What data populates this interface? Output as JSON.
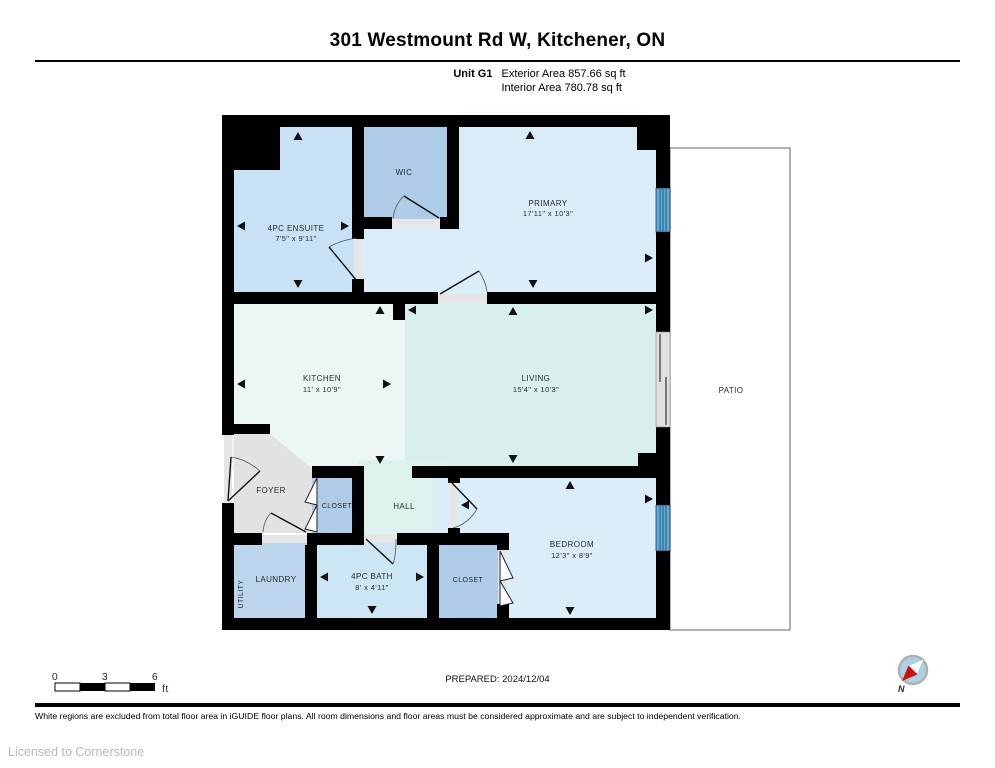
{
  "header": {
    "title": "301 Westmount Rd W, Kitchener, ON",
    "unit": "Unit G1",
    "exterior": "Exterior Area 857.66 sq ft",
    "interior": "Interior Area 780.78 sq ft"
  },
  "rooms": {
    "ensuite": {
      "name": "4PC ENSUITE",
      "dims": "7'5\" x 9'11\""
    },
    "wic": {
      "name": "WIC"
    },
    "primary": {
      "name": "PRIMARY",
      "dims": "17'11\" x 10'3\""
    },
    "kitchen": {
      "name": "KITCHEN",
      "dims": "11' x 10'9\""
    },
    "living": {
      "name": "LIVING",
      "dims": "15'4\" x 10'3\""
    },
    "patio": {
      "name": "PATIO"
    },
    "foyer": {
      "name": "FOYER"
    },
    "closet1": {
      "name": "CLOSET"
    },
    "hall": {
      "name": "HALL"
    },
    "utility": {
      "name": "UTILITY"
    },
    "laundry": {
      "name": "LAUNDRY"
    },
    "bath": {
      "name": "4PC BATH",
      "dims": "8' x 4'11\""
    },
    "closet2": {
      "name": "CLOSET"
    },
    "bedroom": {
      "name": "BEDROOM",
      "dims": "12'3\" x 8'9\""
    }
  },
  "scale_bar": {
    "ticks": [
      "0",
      "3",
      "6"
    ],
    "unit": "ft"
  },
  "compass": {
    "north_label": "N"
  },
  "footer": {
    "prepared": "PREPARED: 2024/12/04",
    "disclaimer": "White regions are excluded from total floor area in iGUIDE floor plans. All room dimensions and floor areas must be considered approximate and are subject to independent verification.",
    "license": "Licensed to Cornerstone"
  },
  "colors": {
    "wall": "#000000",
    "ensuite": "#c8e1f5",
    "wic": "#aecbe8",
    "primary": "#daedf9",
    "kitchen": "#ecf7f5",
    "living": "#d9efee",
    "hall": "#ddf1ee",
    "foyer": "#e2e2e2",
    "closet": "#aecbe8",
    "laundry": "#bdd5ec",
    "bath": "#cde6f6",
    "bedroom": "#daedf9",
    "window": "#5fabdc",
    "sill": "#e6e6e6",
    "patio_border": "#7f7f7f",
    "compass_face": "#a9d3e9",
    "compass_red": "#cc1111"
  }
}
